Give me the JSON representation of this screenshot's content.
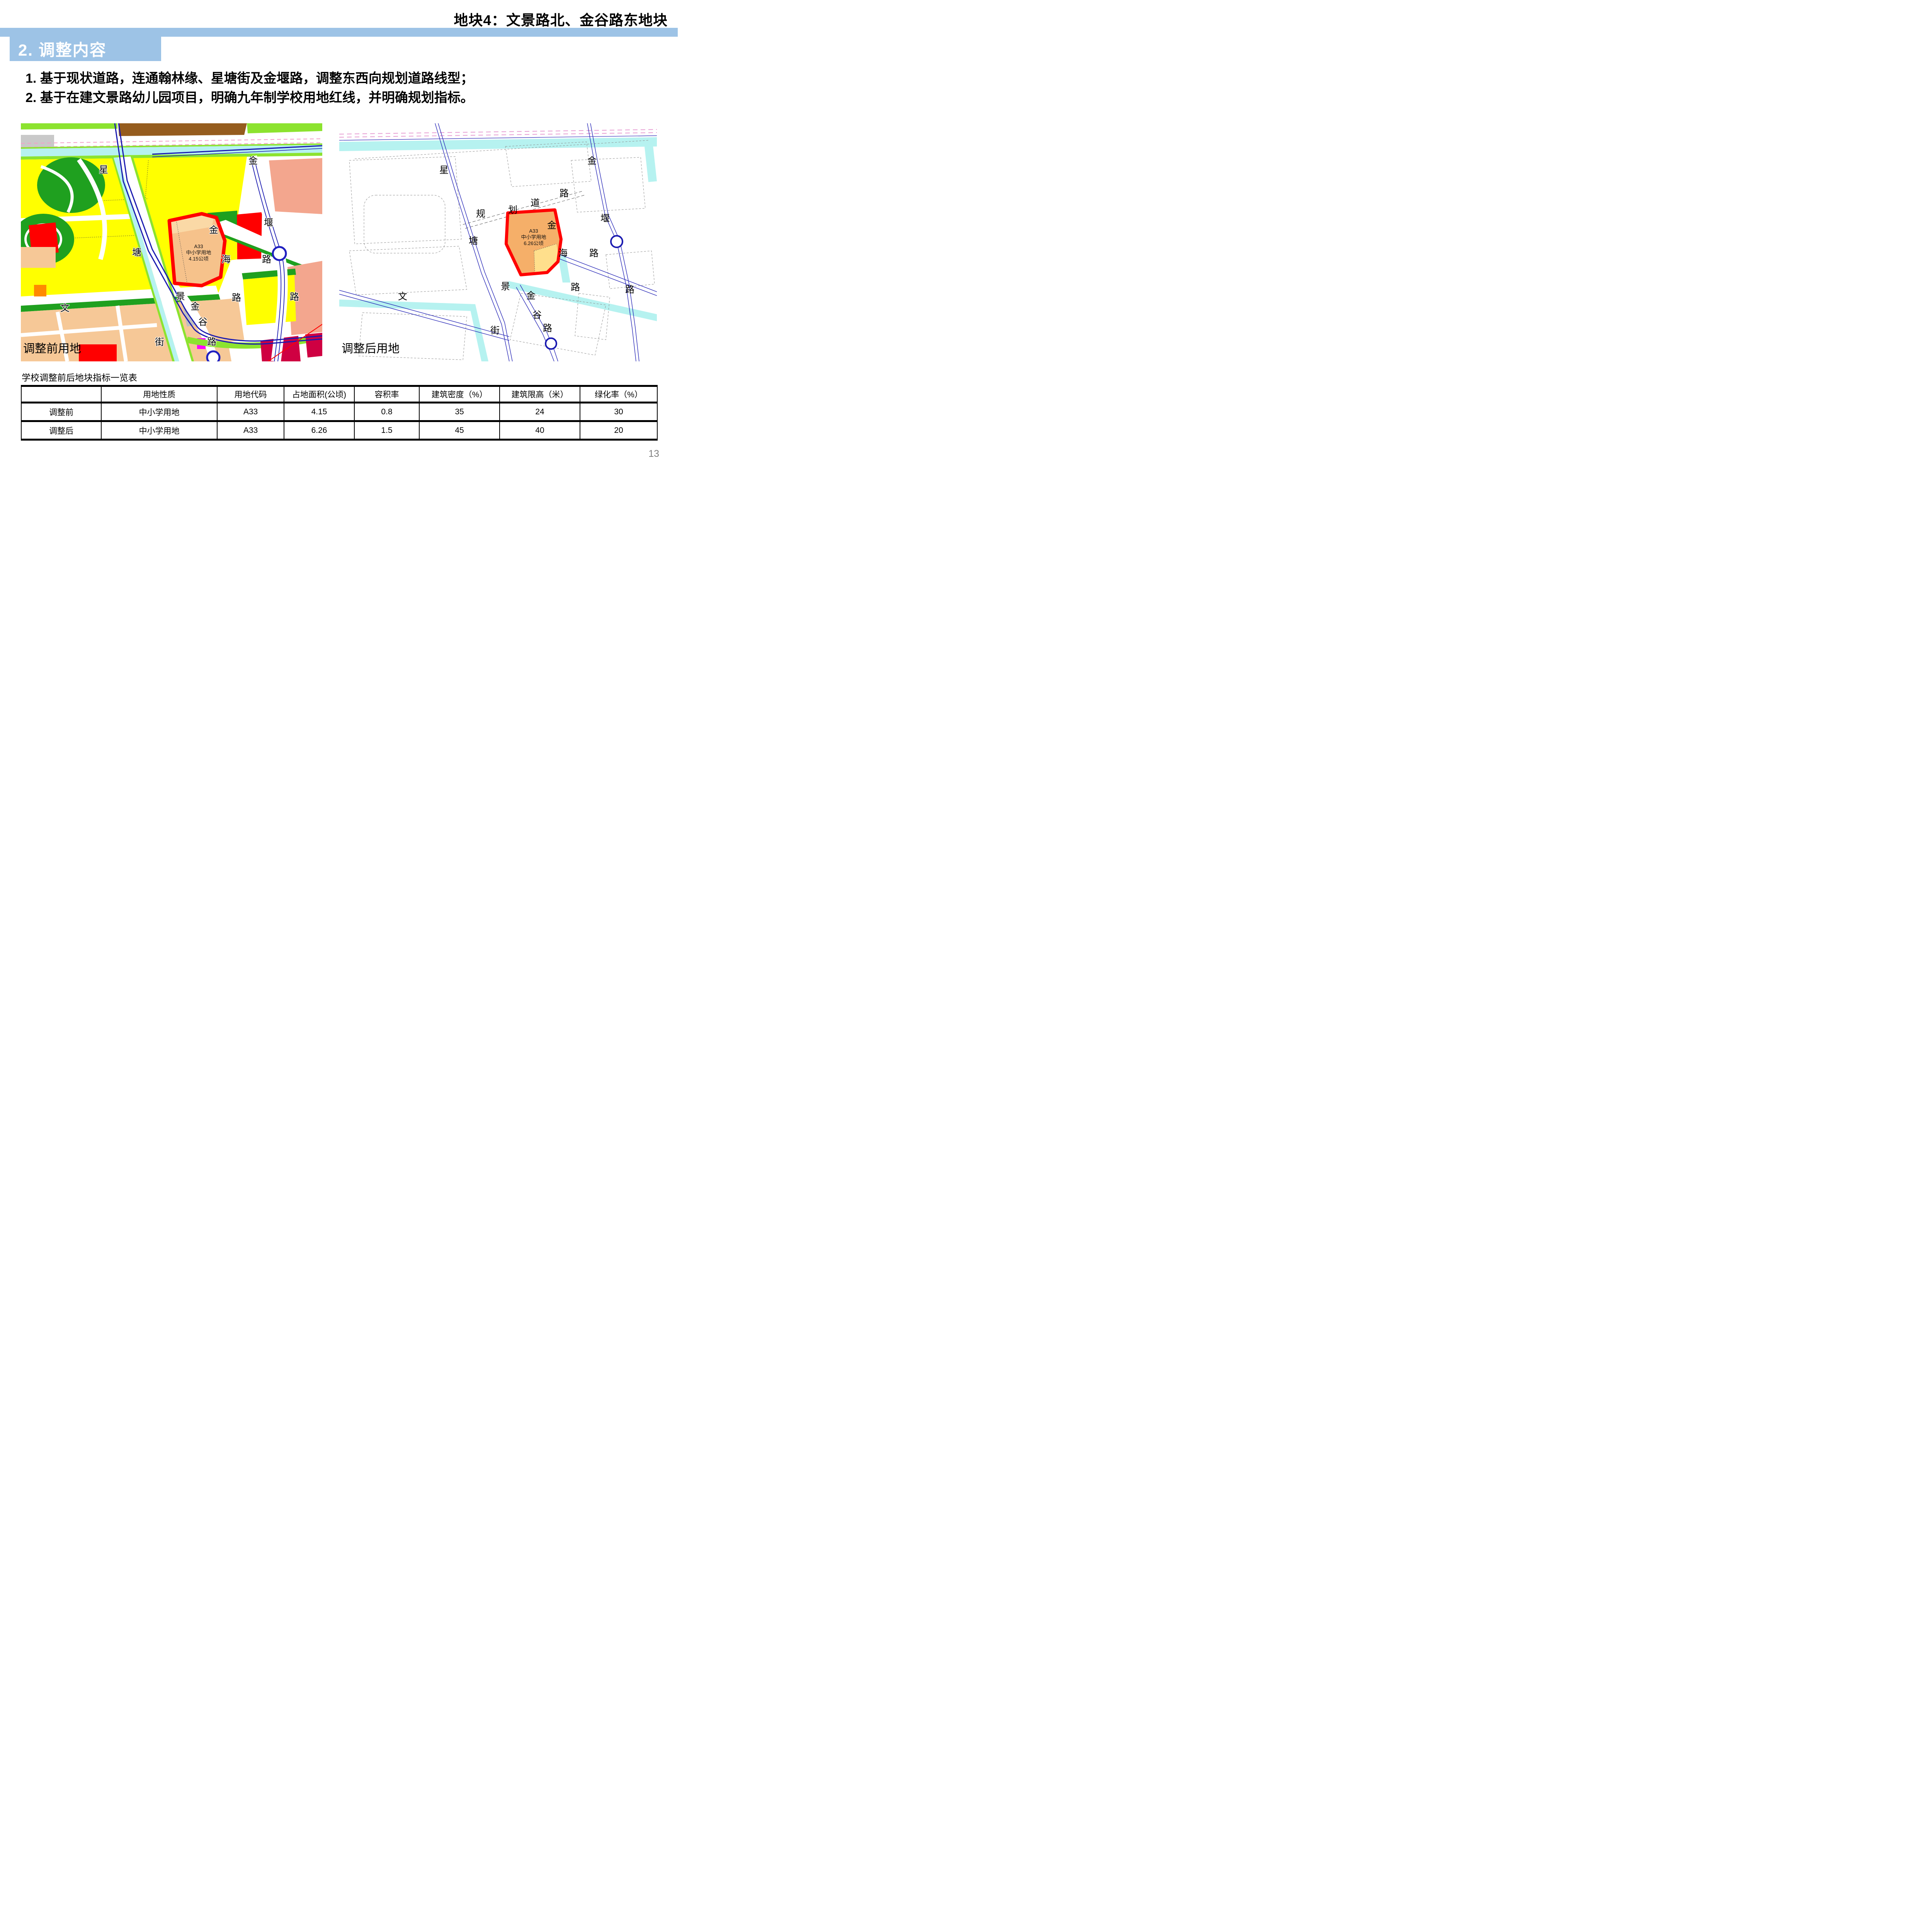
{
  "header": {
    "title": "地块4：文景路北、金谷路东地块"
  },
  "banner": {
    "title": "2. 调整内容"
  },
  "intro": {
    "line1": "1. 基于现状道路，连通翰林缘、星塘街及金堰路，调整东西向规划道路线型；",
    "line2": "2. 基于在建文景路幼儿园项目，明确九年制学校用地红线，并明确规划指标。"
  },
  "maps": {
    "before": {
      "caption": "调整前用地",
      "parcel": {
        "code": "A33",
        "use": "中小学用地",
        "area": "4.15公顷"
      },
      "chars": {
        "c1": "星",
        "c2": "塘",
        "c3": "街",
        "c4": "文",
        "c5": "景",
        "c6": "金",
        "c7": "谷",
        "c8": "路",
        "c9": "金",
        "c10": "海",
        "c11": "路",
        "c12": "金",
        "c13": "堰",
        "c14": "路",
        "c15": "路"
      }
    },
    "after": {
      "caption": "调整后用地",
      "parcel": {
        "code": "A33",
        "use": "中小学用地",
        "area": "6.26公顷"
      },
      "chars": {
        "r1": "星",
        "r2": "塘",
        "r3": "街",
        "r4": "规",
        "r5": "划",
        "r6": "道",
        "r7": "路",
        "r8": "金",
        "r9": "堰",
        "r10": "路",
        "r11": "金",
        "r12": "海",
        "r13": "路",
        "r14": "景",
        "r15": "金",
        "r16": "谷",
        "r17": "路",
        "r18": "文",
        "r19": "路"
      }
    }
  },
  "table": {
    "title": "学校调整前后地块指标一览表",
    "headers": [
      "",
      "用地性质",
      "用地代码",
      "占地面积(公顷)",
      "容积率",
      "建筑密度（%）",
      "建筑限高（米）",
      "绿化率（%）"
    ],
    "rows": [
      {
        "cells": [
          "调整前",
          "中小学用地",
          "A33",
          "4.15",
          "0.8",
          "35",
          "24",
          "30"
        ]
      },
      {
        "cells": [
          "调整后",
          "中小学用地",
          "A33",
          "6.26",
          "1.5",
          "45",
          "40",
          "20"
        ]
      }
    ],
    "highlight_color": "#FF0000"
  },
  "page": {
    "number": "13"
  },
  "colors": {
    "banner_blue": "#9DC3E6",
    "highlight_red": "#FF0000",
    "parcel_orange": "#F5AF69",
    "parcel_orange_light": "#FAD9A6",
    "parcel_yellow_sub": "#FFDF8C",
    "water_cyan": "#B6F2F0",
    "landuse_yellow": "#FFFF00",
    "park_green": "#1FA01F",
    "light_green": "#8CE32F",
    "peach": "#F6C897",
    "salmon": "#F3A68E",
    "magenta": "#FF00FF",
    "brown": "#955C1E",
    "page_number_gray": "#7F7F7F"
  }
}
